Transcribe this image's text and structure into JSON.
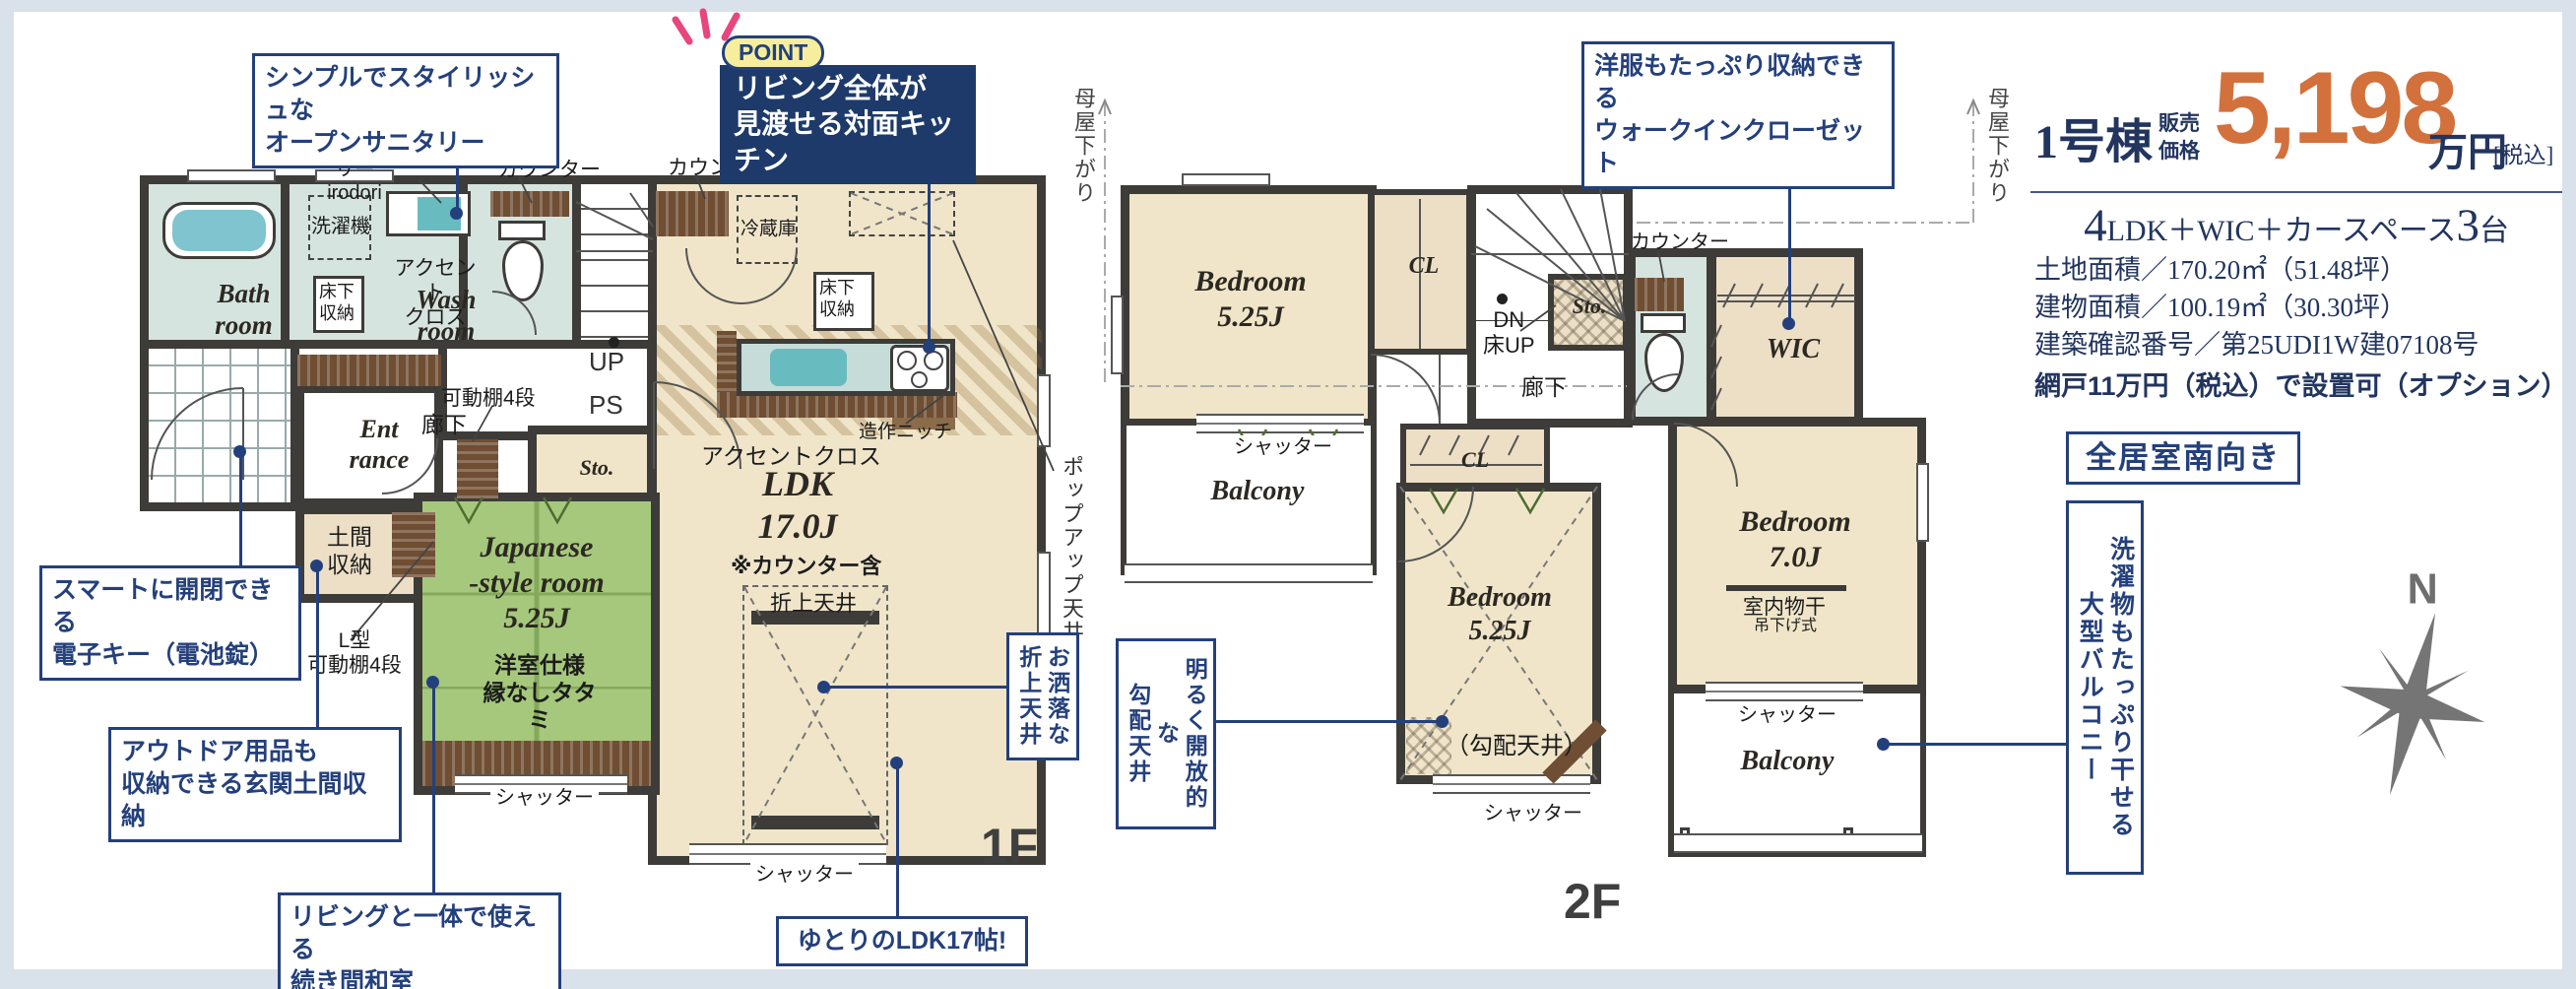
{
  "colors": {
    "accent_navy": "#24407c",
    "price_orange": "#d2713c",
    "wall": "#3e3c39",
    "tatami_green": "#a6c87c",
    "water_teal": "#d6e4e0",
    "room_beige": "#f0e5c9",
    "wood_brown": "#6f4e33",
    "frame_blue": "#d9e1eb"
  },
  "price_panel": {
    "unit": "1号棟",
    "label_line1": "販売",
    "label_line2": "価格",
    "price": "5,198",
    "currency": "万円",
    "tax": "[税込]",
    "spec_big1": "4",
    "spec_mid": "LDK＋WIC＋カースペース",
    "spec_big2": "3",
    "spec_tail": "台",
    "land": "土地面積／170.20㎡（51.48坪）",
    "building": "建物面積／100.19㎡（30.30坪）",
    "approval": "建築確認番号／第25UDI1W建07108号",
    "amido": "網戸11万円（税込）で設置可（オプション）",
    "south": "全居室南向き"
  },
  "annotations": {
    "sanitary": "シンプルでスタイリッシュな\nオープンサニタリー",
    "point_badge": "POINT",
    "point_text": "リビング全体が\n見渡せる対面キッチン",
    "wic": "洋服もたっぷり収納できる\nウォークインクローゼット",
    "key": "スマートに開閉できる\n電子キー（電池錠）",
    "doma": "アウトドア用品も\n収納できる玄関土間収納",
    "washitsu": "リビングと一体で使える\n続き間和室",
    "ldk17": "ゆとりのLDK17帖!",
    "oriage": "お洒落な\n折上天井",
    "kobai": "明るく開放的な\n勾配天井",
    "balcony": "洗濯物もたっぷり干せる\n大型バルコニー"
  },
  "floor1": {
    "name": "1F",
    "open_sanitary": "オープンサニタリー\nirodori",
    "counter": "カウンター",
    "washer": "洗濯機",
    "underfloor": "床下\n収納",
    "accent2": "アクセント\nクロス",
    "accent": "アクセントクロス",
    "bath": "Bath\nroom",
    "wash": "Wash\nroom",
    "entrance": "Ent\nrance",
    "hall": "廊下",
    "shelf4": "可動棚4段",
    "lshelf": "L型\n可動棚4段",
    "doma": "土間\n収納",
    "sto": "Sto.",
    "fridge": "冷蔵庫",
    "niche": "造作ニッチ",
    "ldk": "LDK\n17.0J",
    "counter_note": "※カウンター含",
    "oriage": "折上天井",
    "jp_room": "Japanese\n-style room\n5.25J",
    "jp_sub": "洋室仕様\n縁なしタタミ",
    "up": "UP",
    "ps": "PS",
    "shutter": "シャッター",
    "popup": "ポップアップ天井",
    "moya": "母屋下がり"
  },
  "floor2": {
    "name": "2F",
    "bedroom525": "Bedroom\n5.25J",
    "bedroom70": "Bedroom\n7.0J",
    "cl": "CL",
    "dn": "DN\n床UP",
    "hall": "廊下",
    "sto": "Sto.",
    "counter": "カウンター",
    "wic": "WIC",
    "balcony": "Balcony",
    "shutter": "シャッター",
    "monohoshi": "室内物干",
    "tsurisage": "吊下げ式",
    "kobai": "（勾配天井）",
    "moya": "母屋下がり"
  },
  "compass": {
    "north": "N"
  }
}
